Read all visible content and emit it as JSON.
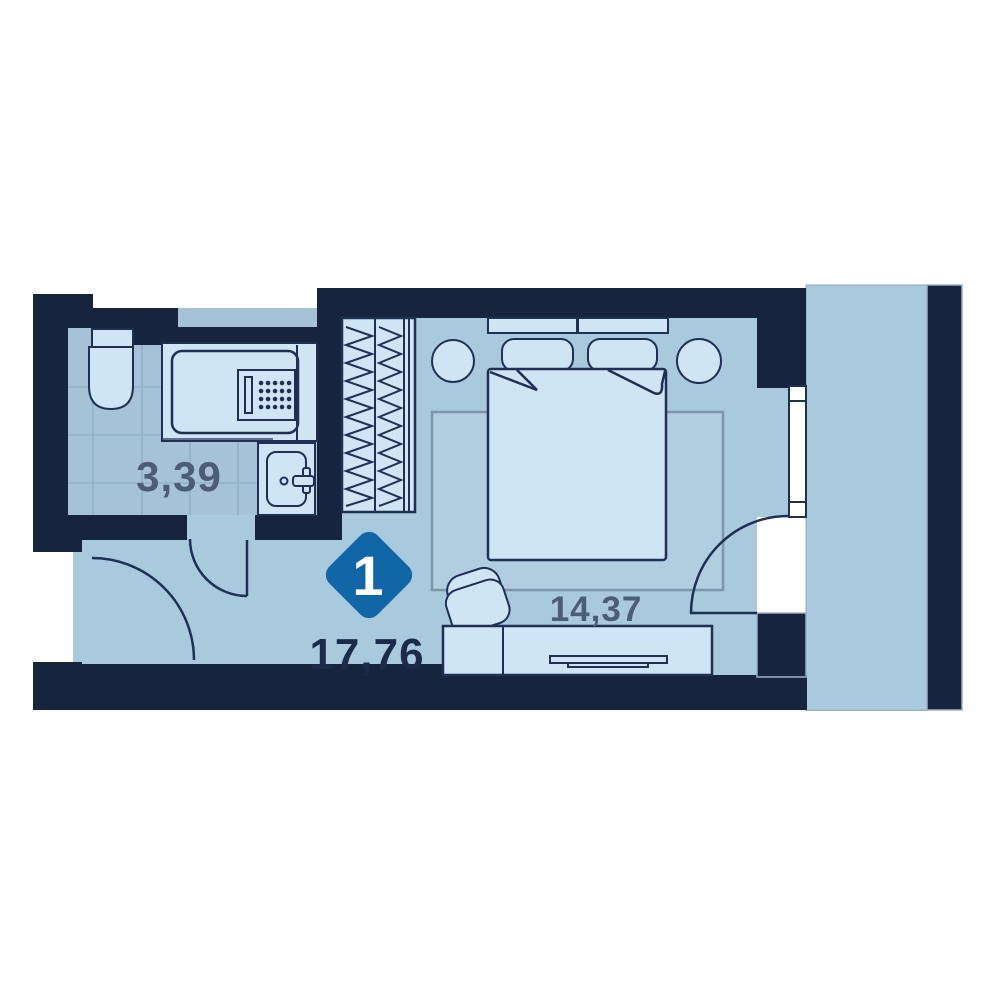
{
  "plan": {
    "type": "floor-plan",
    "badge": {
      "room_count": "1"
    },
    "areas": {
      "bathroom": "3,39",
      "bedroom": "14,37",
      "total": "17,76"
    },
    "icons": {
      "bed": "double-bed-with-pillows",
      "wardrobe": "wardrobe-with-hangers",
      "bathtub": "bathtub",
      "toilet": "toilet",
      "sink": "sink-with-tap",
      "tv_stand": "tv-stand-with-tv",
      "armchair": "armchair",
      "doors": "door-swing-arcs",
      "window": "window",
      "balcony": "balcony"
    },
    "colors": {
      "wall": "#16243e",
      "outline": "#203055",
      "floor": "#a9c9dd",
      "bathroom_floor": "#a6c2d6",
      "furniture": "#cfe5f4",
      "badge_blue": "#1166a8",
      "label_muted": "#4d5d75",
      "label_dark": "#1d2b4a",
      "rug_outline": "#7e96aa"
    }
  }
}
